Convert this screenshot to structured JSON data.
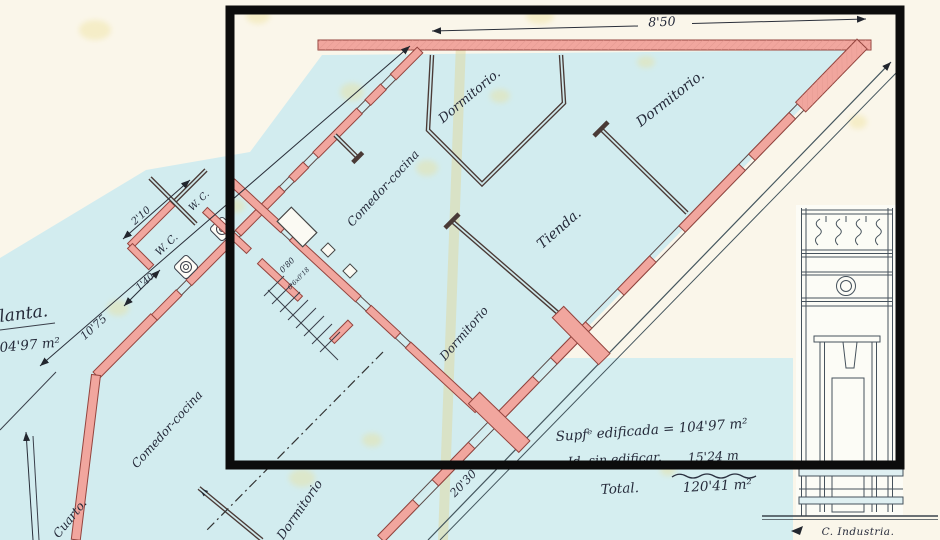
{
  "document": {
    "type": "scanned architectural floor plan",
    "language": "Spanish"
  },
  "colors": {
    "paper_blue": "#d2ecef",
    "paper_cream": "#faf6ea",
    "wall_pink": "#f1a69e",
    "wall_outline": "#94443e",
    "ink": "#3a3f4a",
    "overlay_black": "#0c0c0c",
    "stain_yellow": "#eddf8f"
  },
  "dimensions": {
    "top_width": "8'50",
    "annex_width": "2'10",
    "annex_depth": "1'40",
    "left_side": "10'75",
    "street_side": "20'30",
    "stair_width": "0'80",
    "stair_tread": "0'6x0'18"
  },
  "rooms": {
    "dormitorio_top": "Dormitorio.",
    "dormitorio_top_right": "Dormitorio.",
    "comedor_cocina": "Comedor-cocina",
    "tienda": "Tienda.",
    "dormitorio_center": "Dormitorio",
    "dormitorio_bottom": "Dormitorio",
    "comedor_cocina_bottom": "Comedor-cocina",
    "cuarto": "Cuarto.",
    "wc_upper": "W. C.",
    "wc_lower": "W. C."
  },
  "annotations": {
    "plan_title_partial": "lanta.",
    "plan_area_partial": "04'97 m²",
    "built_area": "Supfᵉ edificada = 104'97 m²",
    "unbuilt_label": "Id. sin edificar.",
    "unbuilt_value": "15'24 m",
    "total_label": "Total.",
    "total_value": "120'41 m²",
    "street_name": "C. Industria."
  }
}
